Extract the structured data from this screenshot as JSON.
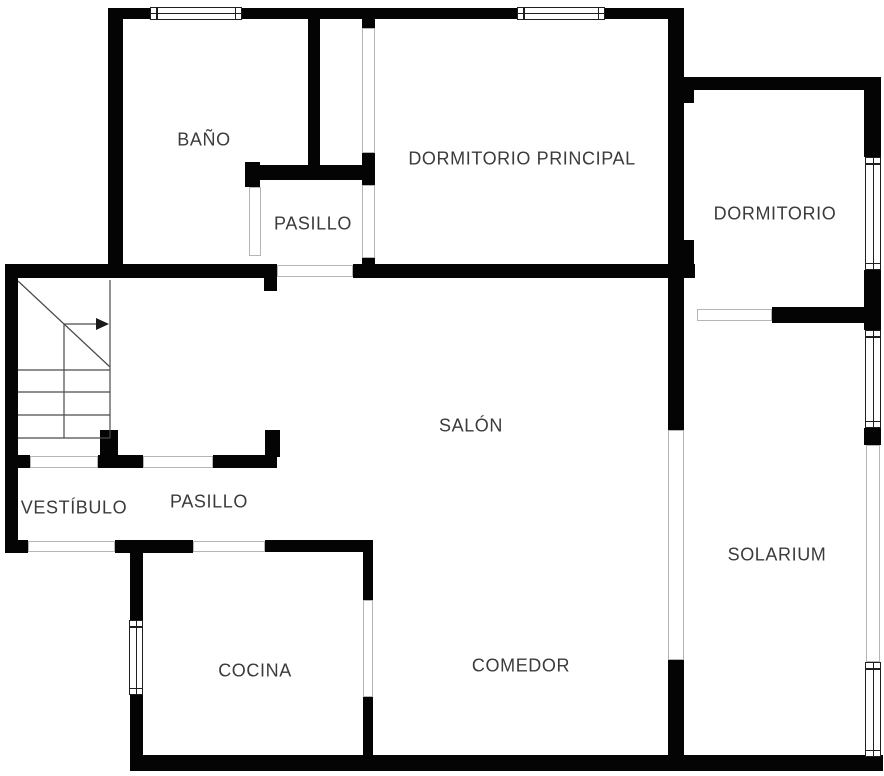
{
  "canvas": {
    "width": 884,
    "height": 776,
    "background": "#ffffff"
  },
  "palette": {
    "wall": "#040404",
    "door_outline": "#b5b5b5",
    "window_frame": "#1f1f1f",
    "stair_line": "#4a4a4a",
    "label": "#3b3b3b"
  },
  "rooms": [
    {
      "id": "bano",
      "label": "BAÑO",
      "cx": 204,
      "cy": 140
    },
    {
      "id": "dormitorio-principal",
      "label": "DORMITORIO PRINCIPAL",
      "cx": 522,
      "cy": 159
    },
    {
      "id": "pasillo-superior",
      "label": "PASILLO",
      "cx": 313,
      "cy": 224
    },
    {
      "id": "dormitorio",
      "label": "DORMITORIO",
      "cx": 775,
      "cy": 214
    },
    {
      "id": "salon",
      "label": "SALÓN",
      "cx": 471,
      "cy": 426
    },
    {
      "id": "vestibulo",
      "label": "VESTÍBULO",
      "cx": 74,
      "cy": 508
    },
    {
      "id": "pasillo-inferior",
      "label": "PASILLO",
      "cx": 209,
      "cy": 502
    },
    {
      "id": "solarium",
      "label": "SOLARIUM",
      "cx": 777,
      "cy": 555
    },
    {
      "id": "cocina",
      "label": "COCINA",
      "cx": 255,
      "cy": 671
    },
    {
      "id": "comedor",
      "label": "COMEDOR",
      "cx": 521,
      "cy": 666
    }
  ],
  "walls": [
    {
      "id": "top-wall",
      "x": 108,
      "y": 8,
      "w": 576,
      "h": 11
    },
    {
      "id": "left-upper-wall",
      "x": 108,
      "y": 8,
      "w": 15,
      "h": 270
    },
    {
      "id": "mid-left-wall",
      "x": 5,
      "y": 264,
      "w": 272,
      "h": 14
    },
    {
      "id": "mid-left-stub",
      "x": 264,
      "y": 278,
      "w": 13,
      "h": 13
    },
    {
      "id": "mid-right-wall",
      "x": 353,
      "y": 264,
      "w": 342,
      "h": 14
    },
    {
      "id": "left-outer-lower-wall",
      "x": 5,
      "y": 264,
      "w": 13,
      "h": 289
    },
    {
      "id": "left-outer-foot",
      "x": 5,
      "y": 540,
      "w": 23,
      "h": 13
    },
    {
      "id": "left-outer-foot-upper",
      "x": 18,
      "y": 455,
      "w": 12,
      "h": 13
    },
    {
      "id": "hall-wall-a",
      "x": 98,
      "y": 455,
      "w": 45,
      "h": 13
    },
    {
      "id": "hall-stub-a",
      "x": 100,
      "y": 430,
      "w": 18,
      "h": 27
    },
    {
      "id": "hall-wall-b",
      "x": 213,
      "y": 455,
      "w": 64,
      "h": 13
    },
    {
      "id": "hall-stub-b",
      "x": 265,
      "y": 430,
      "w": 15,
      "h": 27
    },
    {
      "id": "vestibulo-bottom-wall",
      "x": 115,
      "y": 540,
      "w": 78,
      "h": 13
    },
    {
      "id": "cocina-top-wall",
      "x": 265,
      "y": 540,
      "w": 108,
      "h": 12
    },
    {
      "id": "cocina-left-upper",
      "x": 130,
      "y": 540,
      "w": 13,
      "h": 80
    },
    {
      "id": "cocina-left-lower",
      "x": 130,
      "y": 695,
      "w": 13,
      "h": 64
    },
    {
      "id": "cocina-right-upper",
      "x": 363,
      "y": 543,
      "w": 10,
      "h": 57
    },
    {
      "id": "cocina-right-lower",
      "x": 363,
      "y": 697,
      "w": 10,
      "h": 62
    },
    {
      "id": "bottom-wall",
      "x": 130,
      "y": 755,
      "w": 753,
      "h": 16
    },
    {
      "id": "salon-divider-upper",
      "x": 668,
      "y": 278,
      "w": 16,
      "h": 152
    },
    {
      "id": "salon-divider-lower",
      "x": 668,
      "y": 660,
      "w": 16,
      "h": 97
    },
    {
      "id": "bedroom-divider",
      "x": 668,
      "y": 8,
      "w": 16,
      "h": 270
    },
    {
      "id": "divider-step-top",
      "x": 684,
      "y": 77,
      "w": 10,
      "h": 26
    },
    {
      "id": "divider-step-bottom",
      "x": 684,
      "y": 240,
      "w": 10,
      "h": 38
    },
    {
      "id": "dormitorio-top-wall",
      "x": 673,
      "y": 77,
      "w": 208,
      "h": 13
    },
    {
      "id": "right-wall-a",
      "x": 864,
      "y": 77,
      "w": 17,
      "h": 80
    },
    {
      "id": "right-wall-b",
      "x": 864,
      "y": 270,
      "w": 17,
      "h": 60
    },
    {
      "id": "right-wall-stub",
      "x": 864,
      "y": 428,
      "w": 17,
      "h": 17
    },
    {
      "id": "dormitorio-bottom-wall",
      "x": 772,
      "y": 307,
      "w": 109,
      "h": 16
    },
    {
      "id": "bano-right-wall",
      "x": 308,
      "y": 8,
      "w": 12,
      "h": 164
    },
    {
      "id": "pasillo-top-wall",
      "x": 245,
      "y": 165,
      "w": 117,
      "h": 15
    },
    {
      "id": "pasillo-top-cap-left",
      "x": 245,
      "y": 162,
      "w": 15,
      "h": 25
    },
    {
      "id": "pasillo-top-cap-right",
      "x": 362,
      "y": 153,
      "w": 13,
      "h": 32
    },
    {
      "id": "wardrobe-stub-top",
      "x": 362,
      "y": 18,
      "w": 13,
      "h": 10
    },
    {
      "id": "pasillo-stub-bottom",
      "x": 362,
      "y": 258,
      "w": 13,
      "h": 20
    }
  ],
  "doors": [
    {
      "id": "wardrobe-sliding-door",
      "x": 362,
      "y": 28,
      "w": 13,
      "h": 125
    },
    {
      "id": "door-pasillo-dormitorio",
      "x": 362,
      "y": 185,
      "w": 13,
      "h": 73
    },
    {
      "id": "door-bano",
      "x": 249,
      "y": 187,
      "w": 12,
      "h": 69
    },
    {
      "id": "opening-pasillo-salon",
      "x": 277,
      "y": 265,
      "w": 76,
      "h": 12
    },
    {
      "id": "door-hall-pasillo",
      "x": 143,
      "y": 456,
      "w": 70,
      "h": 12
    },
    {
      "id": "opening-stairs-vestibulo",
      "x": 30,
      "y": 456,
      "w": 68,
      "h": 12
    },
    {
      "id": "door-vestibulo-entrance",
      "x": 28,
      "y": 541,
      "w": 87,
      "h": 11
    },
    {
      "id": "door-pasillo-cocina",
      "x": 193,
      "y": 541,
      "w": 72,
      "h": 11
    },
    {
      "id": "door-cocina-comedor",
      "x": 363,
      "y": 600,
      "w": 10,
      "h": 97
    },
    {
      "id": "opening-salon-solarium",
      "x": 668,
      "y": 430,
      "w": 16,
      "h": 230
    },
    {
      "id": "door-dormitorio-solarium",
      "x": 697,
      "y": 309,
      "w": 75,
      "h": 12
    },
    {
      "id": "glass-panel-solarium-right",
      "x": 866,
      "y": 445,
      "w": 14,
      "h": 217
    }
  ],
  "windows": [
    {
      "id": "window-bano-top",
      "x": 150,
      "y": 7,
      "w": 92,
      "h": 13,
      "o": "h"
    },
    {
      "id": "window-dormprincipal-top",
      "x": 517,
      "y": 7,
      "w": 88,
      "h": 13,
      "o": "h"
    },
    {
      "id": "window-dormitorio-right",
      "x": 865,
      "y": 157,
      "w": 16,
      "h": 113,
      "o": "v"
    },
    {
      "id": "window-solarium-right-1",
      "x": 865,
      "y": 330,
      "w": 16,
      "h": 98,
      "o": "v"
    },
    {
      "id": "window-solarium-right-2",
      "x": 865,
      "y": 662,
      "w": 16,
      "h": 95,
      "o": "v"
    },
    {
      "id": "window-cocina-left",
      "x": 129,
      "y": 620,
      "w": 14,
      "h": 75,
      "o": "v"
    }
  ],
  "stairs": {
    "lines": [
      {
        "x1": 110,
        "y1": 280,
        "x2": 110,
        "y2": 438
      },
      {
        "x1": 18,
        "y1": 438,
        "x2": 110,
        "y2": 438
      },
      {
        "x1": 18,
        "y1": 370,
        "x2": 110,
        "y2": 370
      },
      {
        "x1": 18,
        "y1": 392,
        "x2": 110,
        "y2": 392
      },
      {
        "x1": 18,
        "y1": 415,
        "x2": 110,
        "y2": 415
      },
      {
        "x1": 64,
        "y1": 324,
        "x2": 64,
        "y2": 438
      },
      {
        "x1": 18,
        "y1": 281,
        "x2": 110,
        "y2": 367
      }
    ],
    "arrow": {
      "shaft": {
        "x1": 64,
        "y1": 324,
        "x2": 97,
        "y2": 324
      },
      "head": "96,318 96,330 109,324"
    }
  }
}
